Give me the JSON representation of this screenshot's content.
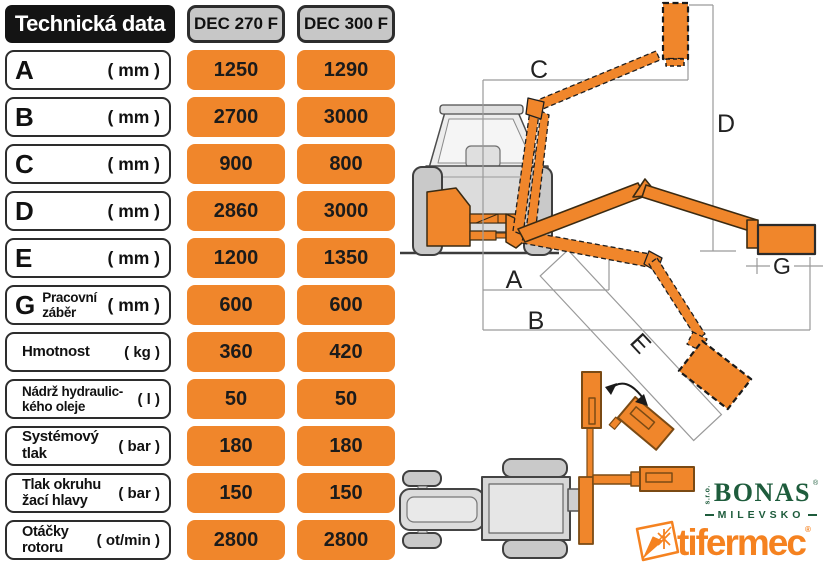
{
  "table": {
    "title": "Technická data",
    "columns": [
      "DEC 270 F",
      "DEC 300 F"
    ],
    "rows": [
      {
        "letter": "A",
        "line1": "",
        "line2": "",
        "unit": "( mm )",
        "v1": "1250",
        "v2": "1290"
      },
      {
        "letter": "B",
        "line1": "",
        "line2": "",
        "unit": "( mm )",
        "v1": "2700",
        "v2": "3000"
      },
      {
        "letter": "C",
        "line1": "",
        "line2": "",
        "unit": "( mm )",
        "v1": "900",
        "v2": "800"
      },
      {
        "letter": "D",
        "line1": "",
        "line2": "",
        "unit": "( mm )",
        "v1": "2860",
        "v2": "3000"
      },
      {
        "letter": "E",
        "line1": "",
        "line2": "",
        "unit": "( mm )",
        "v1": "1200",
        "v2": "1350"
      },
      {
        "letter": "G",
        "line1": "Pracovní",
        "line2": "záběr",
        "unit": "( mm )",
        "v1": "600",
        "v2": "600"
      },
      {
        "letter": "",
        "line1": "Hmotnost",
        "line2": "",
        "unit": "( kg )",
        "v1": "360",
        "v2": "420"
      },
      {
        "letter": "",
        "line1": "Nádrž hydraulic-",
        "line2": "kého oleje",
        "unit": "( l )",
        "v1": "50",
        "v2": "50"
      },
      {
        "letter": "",
        "line1": "Systémový tlak",
        "line2": "",
        "unit": "( bar )",
        "v1": "180",
        "v2": "180"
      },
      {
        "letter": "",
        "line1": "Tlak okruhu",
        "line2": "žací hlavy",
        "unit": "( bar )",
        "v1": "150",
        "v2": "150"
      },
      {
        "letter": "",
        "line1": "Otáčky",
        "line2": "rotoru",
        "unit": "( ot/min )",
        "v1": "2800",
        "v2": "2800"
      }
    ]
  },
  "diagram": {
    "labels": {
      "a": "A",
      "b": "B",
      "c": "C",
      "d": "D",
      "e": "E",
      "g": "G"
    }
  },
  "logos": {
    "bonas_prefix": "s.r.o.",
    "bonas_name": "BONAS",
    "bonas_reg": "®",
    "bonas_city": "MILEVSKO",
    "tifermec_name": "tifermec",
    "tifermec_reg": "®"
  },
  "colors": {
    "accent_orange": "#F0862B",
    "header_gray": "#C7C7C7",
    "title_black": "#141414",
    "bonas_green": "#1E5C3C",
    "tifermec_orange": "#F58220"
  }
}
